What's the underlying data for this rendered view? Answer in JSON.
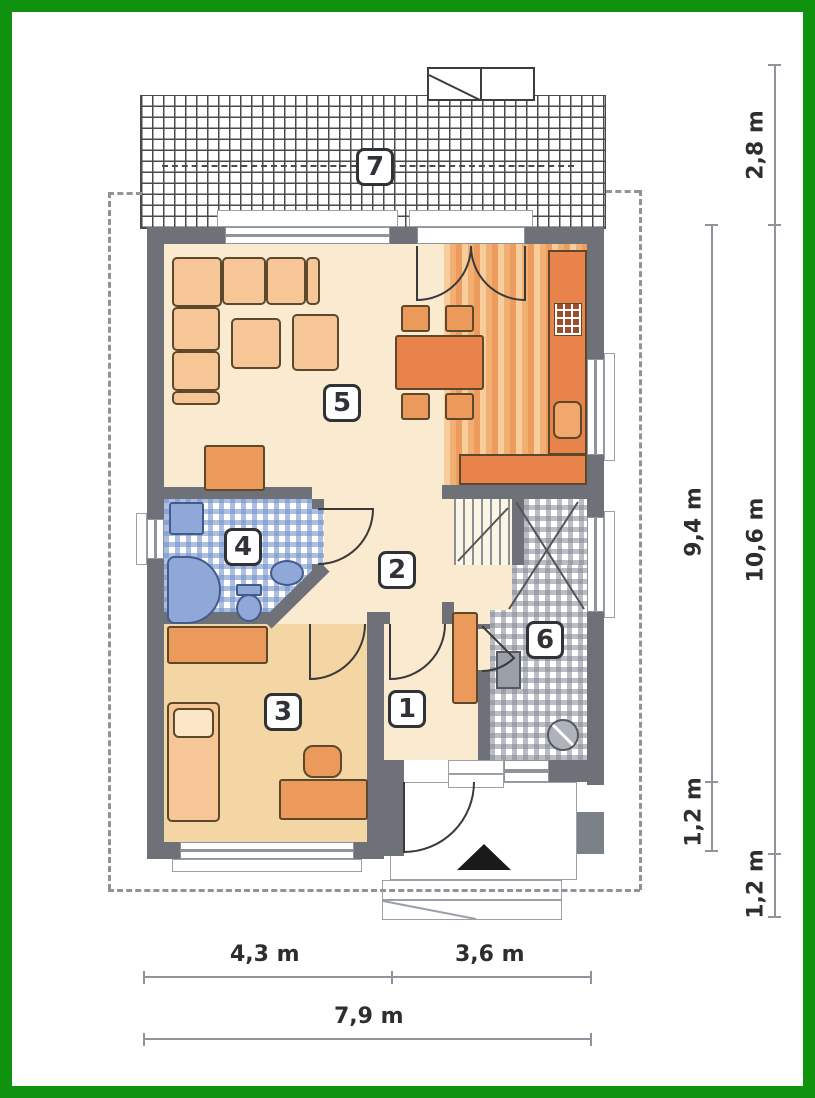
{
  "plan_title": "",
  "rooms": {
    "r1": "1",
    "r2": "2",
    "r3": "3",
    "r4": "4",
    "r5": "5",
    "r6": "6",
    "r7": "7"
  },
  "dims": {
    "right_28": "2,8 m",
    "right_94": "9,4 m",
    "right_106": "10,6 m",
    "right_12_inner": "1,2 m",
    "right_12_outer": "1,2 m",
    "bottom_43": "4,3 m",
    "bottom_36": "3,6 m",
    "bottom_79": "7,9 m"
  },
  "markers": {
    "entrance_marker": "triangle-up"
  },
  "colors": {
    "frame_green": "#0f930f",
    "wall_gray": "#6e7177",
    "floor_cream": "#f9ead0",
    "floor_tan": "#f3d6a4",
    "furniture_light": "#f6c697",
    "furniture_orange": "#eb9a5c",
    "furniture_deep": "#e8834b",
    "bath_blue": "#8fa8d8",
    "tile_blue": "#7494cd",
    "tile_gray": "#82878f"
  }
}
